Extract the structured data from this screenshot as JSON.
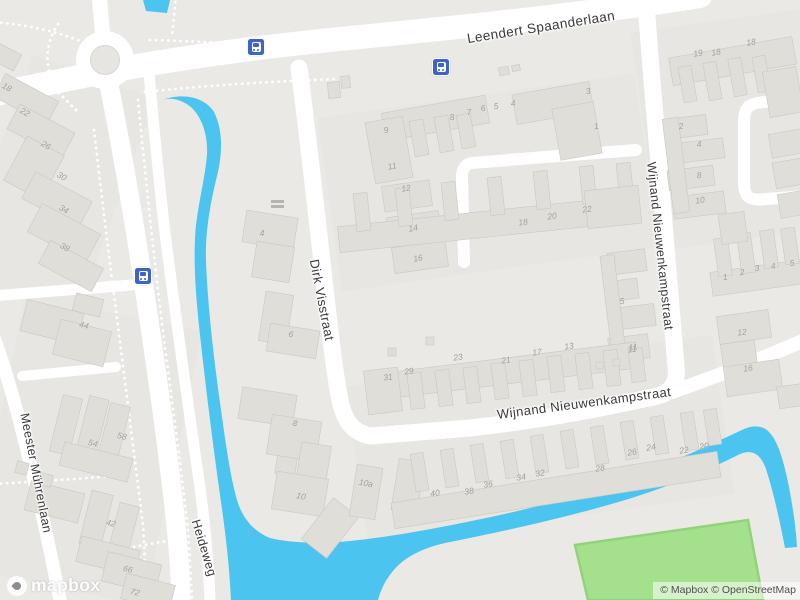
{
  "map": {
    "attribution": {
      "text": "© Mapbox © OpenStreetMap"
    },
    "logo_text": "mapbox",
    "colors": {
      "land": "#ebe9e6",
      "water": "#4cc4f0",
      "road": "#ffffff",
      "building": "#e0ded9",
      "field_green": "#a5e18c",
      "bus_blue": "#3f63c8",
      "label": "#3a3a3a"
    },
    "street_labels": [
      {
        "text": "Leendert Spaanderlaan",
        "x": 541,
        "y": 27,
        "r": -9,
        "size": 13.5
      },
      {
        "text": "Dirk Visstraat",
        "x": 322,
        "y": 300,
        "r": 79,
        "size": 13
      },
      {
        "text": "Wijnand Nieuwenkampstraat",
        "x": 660,
        "y": 246,
        "r": 84,
        "size": 12.5
      },
      {
        "text": "Wijnand Nieuwenkampstraat",
        "x": 584,
        "y": 403,
        "r": -7.5,
        "size": 13
      },
      {
        "text": "Meester Mührenlaan",
        "x": 36,
        "y": 473,
        "r": 79,
        "size": 12.5
      },
      {
        "text": "Heideweg",
        "x": 204,
        "y": 548,
        "r": 73,
        "size": 12.5
      }
    ],
    "bus_stops": [
      {
        "x": 256,
        "y": 47
      },
      {
        "x": 441,
        "y": 67
      },
      {
        "x": 143,
        "y": 276
      }
    ],
    "house_numbers": [
      {
        "t": "18",
        "x": 7,
        "y": 87,
        "r": 30
      },
      {
        "t": "22",
        "x": 25,
        "y": 112,
        "r": 30
      },
      {
        "t": "26",
        "x": 46,
        "y": 145,
        "r": 30
      },
      {
        "t": "30",
        "x": 62,
        "y": 176,
        "r": 30
      },
      {
        "t": "34",
        "x": 64,
        "y": 209,
        "r": 30
      },
      {
        "t": "38",
        "x": 65,
        "y": 247,
        "r": 30
      },
      {
        "t": "44",
        "x": 84,
        "y": 325,
        "r": 14
      },
      {
        "t": "54",
        "x": 93,
        "y": 443,
        "r": 14
      },
      {
        "t": "58",
        "x": 122,
        "y": 436,
        "r": 14
      },
      {
        "t": "42",
        "x": 111,
        "y": 523,
        "r": 14
      },
      {
        "t": "66",
        "x": 128,
        "y": 569,
        "r": 14
      },
      {
        "t": "72",
        "x": 135,
        "y": 592,
        "r": 14
      },
      {
        "t": "4",
        "x": 262,
        "y": 233,
        "r": 0
      },
      {
        "t": "6",
        "x": 291,
        "y": 334,
        "r": 10
      },
      {
        "t": "8",
        "x": 295,
        "y": 423,
        "r": 10
      },
      {
        "t": "10",
        "x": 301,
        "y": 496,
        "r": 10
      },
      {
        "t": "10a",
        "x": 366,
        "y": 483,
        "r": 10
      },
      {
        "t": "9",
        "x": 386,
        "y": 130,
        "r": -10
      },
      {
        "t": "11",
        "x": 392,
        "y": 166,
        "r": -10
      },
      {
        "t": "12",
        "x": 406,
        "y": 188,
        "r": -10
      },
      {
        "t": "14",
        "x": 413,
        "y": 228,
        "r": -10
      },
      {
        "t": "16",
        "x": 418,
        "y": 258,
        "r": -10
      },
      {
        "t": "8",
        "x": 452,
        "y": 117,
        "r": -10
      },
      {
        "t": "7",
        "x": 469,
        "y": 112,
        "r": -10
      },
      {
        "t": "6",
        "x": 483,
        "y": 108,
        "r": -10
      },
      {
        "t": "5",
        "x": 496,
        "y": 106,
        "r": -10
      },
      {
        "t": "4",
        "x": 513,
        "y": 103,
        "r": -10
      },
      {
        "t": "3",
        "x": 588,
        "y": 91,
        "r": -10
      },
      {
        "t": "1",
        "x": 596,
        "y": 126,
        "r": -10
      },
      {
        "t": "18",
        "x": 523,
        "y": 222,
        "r": -8
      },
      {
        "t": "20",
        "x": 552,
        "y": 216,
        "r": -8
      },
      {
        "t": "22",
        "x": 587,
        "y": 209,
        "r": -8
      },
      {
        "t": "19",
        "x": 698,
        "y": 53,
        "r": -10
      },
      {
        "t": "18",
        "x": 716,
        "y": 52,
        "r": -10
      },
      {
        "t": "18",
        "x": 751,
        "y": 42,
        "r": -10
      },
      {
        "t": "2",
        "x": 681,
        "y": 126,
        "r": -8
      },
      {
        "t": "4",
        "x": 699,
        "y": 144,
        "r": -8
      },
      {
        "t": "8",
        "x": 699,
        "y": 175,
        "r": -8
      },
      {
        "t": "10",
        "x": 700,
        "y": 200,
        "r": -8
      },
      {
        "t": "5",
        "x": 622,
        "y": 301,
        "r": -8
      },
      {
        "t": "11",
        "x": 633,
        "y": 347,
        "r": -8
      },
      {
        "t": "1",
        "x": 725,
        "y": 277,
        "r": -8
      },
      {
        "t": "2",
        "x": 742,
        "y": 272,
        "r": -8
      },
      {
        "t": "3",
        "x": 757,
        "y": 268,
        "r": -8
      },
      {
        "t": "4",
        "x": 773,
        "y": 266,
        "r": -8
      },
      {
        "t": "5",
        "x": 792,
        "y": 263,
        "r": -8
      },
      {
        "t": "12",
        "x": 742,
        "y": 332,
        "r": -8
      },
      {
        "t": "16",
        "x": 748,
        "y": 368,
        "r": -8
      },
      {
        "t": "31",
        "x": 388,
        "y": 377,
        "r": -8
      },
      {
        "t": "29",
        "x": 409,
        "y": 371,
        "r": -8
      },
      {
        "t": "23",
        "x": 458,
        "y": 357,
        "r": -8
      },
      {
        "t": "21",
        "x": 506,
        "y": 360,
        "r": -8
      },
      {
        "t": "17",
        "x": 537,
        "y": 352,
        "r": -8
      },
      {
        "t": "13",
        "x": 569,
        "y": 346,
        "r": -8
      },
      {
        "t": "11",
        "x": 632,
        "y": 349,
        "r": -8
      },
      {
        "t": "40",
        "x": 435,
        "y": 493,
        "r": -9
      },
      {
        "t": "38",
        "x": 469,
        "y": 491,
        "r": -9
      },
      {
        "t": "36",
        "x": 488,
        "y": 484,
        "r": -9
      },
      {
        "t": "34",
        "x": 521,
        "y": 477,
        "r": -9
      },
      {
        "t": "32",
        "x": 540,
        "y": 473,
        "r": -9
      },
      {
        "t": "28",
        "x": 600,
        "y": 468,
        "r": -9
      },
      {
        "t": "26",
        "x": 632,
        "y": 452,
        "r": -9
      },
      {
        "t": "24",
        "x": 651,
        "y": 447,
        "r": -9
      },
      {
        "t": "22",
        "x": 684,
        "y": 450,
        "r": -9
      },
      {
        "t": "20",
        "x": 704,
        "y": 446,
        "r": -9
      }
    ]
  }
}
